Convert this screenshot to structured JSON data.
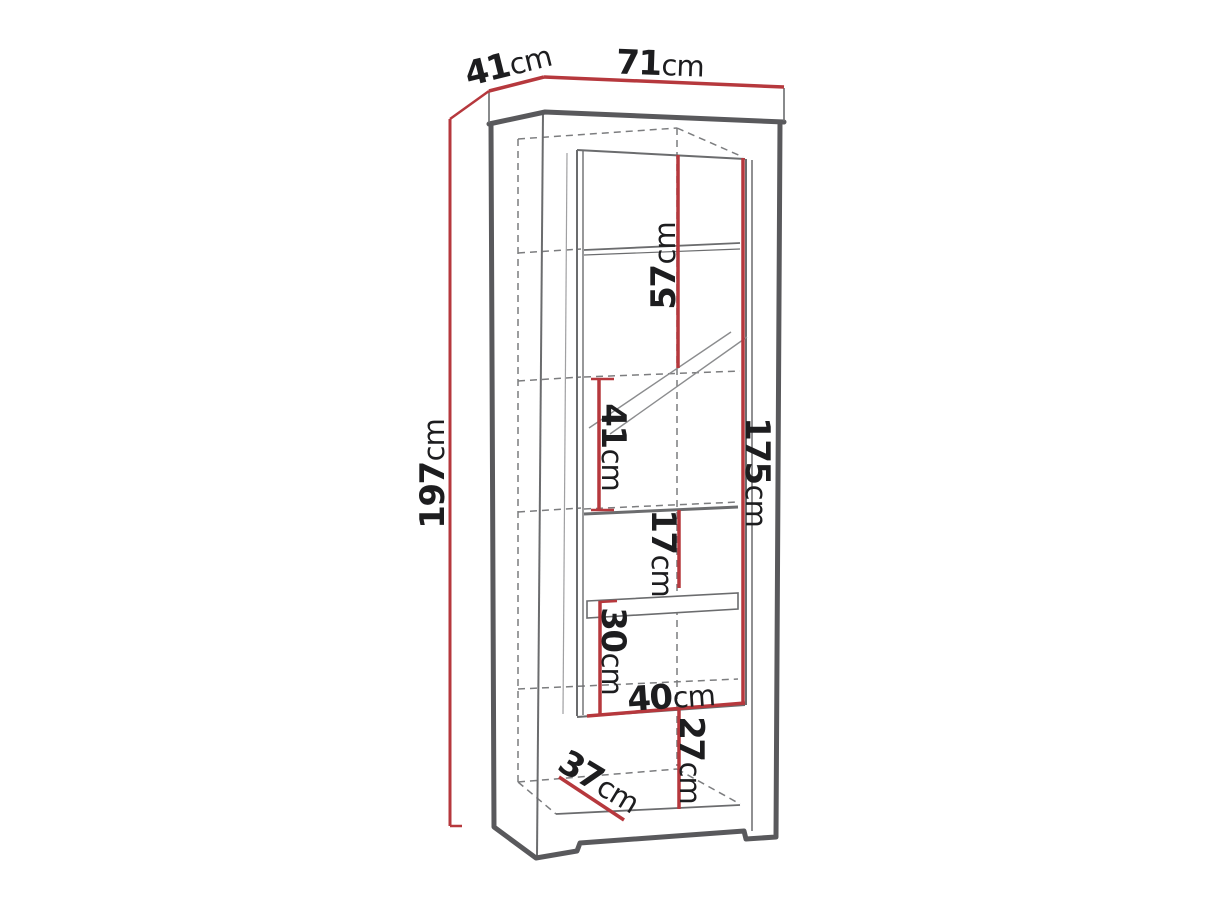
{
  "diagram": {
    "type": "furniture-dimension-diagram",
    "subject": "Tall display cabinet (vitrine) line drawing in perspective with dimension callouts",
    "unit": "cm",
    "colors": {
      "dimension_line": "#b6383d",
      "outline": "#59595c",
      "inner_line": "#6b6c6e",
      "dashed_line": "#7c7d7f",
      "text": "#1d1d1f",
      "background": "#ffffff"
    },
    "dimensions": {
      "depth_top": {
        "value": "41",
        "unit": "cm",
        "meaning": "top depth"
      },
      "width_top": {
        "value": "71",
        "unit": "cm",
        "meaning": "top width"
      },
      "height_total": {
        "value": "197",
        "unit": "cm",
        "meaning": "total height"
      },
      "upper_section": {
        "value": "57",
        "unit": "cm",
        "meaning": "upper glass section height"
      },
      "middle_section": {
        "value": "41",
        "unit": "cm",
        "meaning": "middle glass section height"
      },
      "door_height": {
        "value": "175",
        "unit": "cm",
        "meaning": "door height"
      },
      "small_section": {
        "value": "17",
        "unit": "cm",
        "meaning": "small shelf section height"
      },
      "lower_section": {
        "value": "30",
        "unit": "cm",
        "meaning": "lower shelf section height"
      },
      "inner_width": {
        "value": "40",
        "unit": "cm",
        "meaning": "inner width"
      },
      "bottom_section": {
        "value": "27",
        "unit": "cm",
        "meaning": "bottom compartment height"
      },
      "inner_depth": {
        "value": "37",
        "unit": "cm",
        "meaning": "inner depth"
      }
    }
  }
}
